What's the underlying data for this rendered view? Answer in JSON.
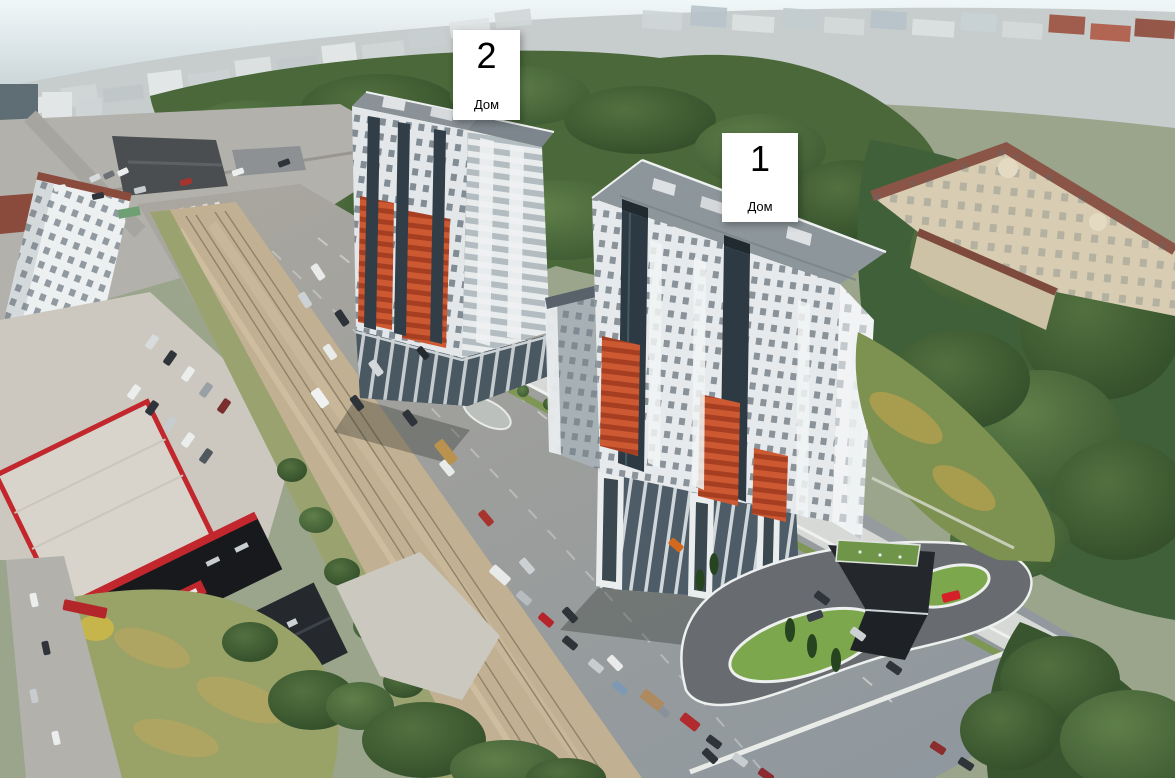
{
  "annotations": {
    "building2": {
      "number": "2",
      "caption": "Дом"
    },
    "building1": {
      "number": "1",
      "caption": "Дом"
    }
  },
  "colors": {
    "sky_top": "#f0f7f9",
    "haze_city": "#c7cccc",
    "tree_dark": "#3a5730",
    "tree_mid": "#547243",
    "lawn_render": "#7da74c",
    "lawn_dry": "#99a267",
    "road_asphalt": "#9c9e9c",
    "median_dust": "#c2b093",
    "building_white": "#e7eaec",
    "building_roof": "#8d969b",
    "accent_orange": "#cd5933",
    "glass_dark": "#2e3a43",
    "podium_dark": "#333a40",
    "mall_red": "#c1272d",
    "classical_beige": "#d8cdb2",
    "classical_roof": "#8a5547",
    "label_background": "#ffffff",
    "label_text": "#000000"
  }
}
